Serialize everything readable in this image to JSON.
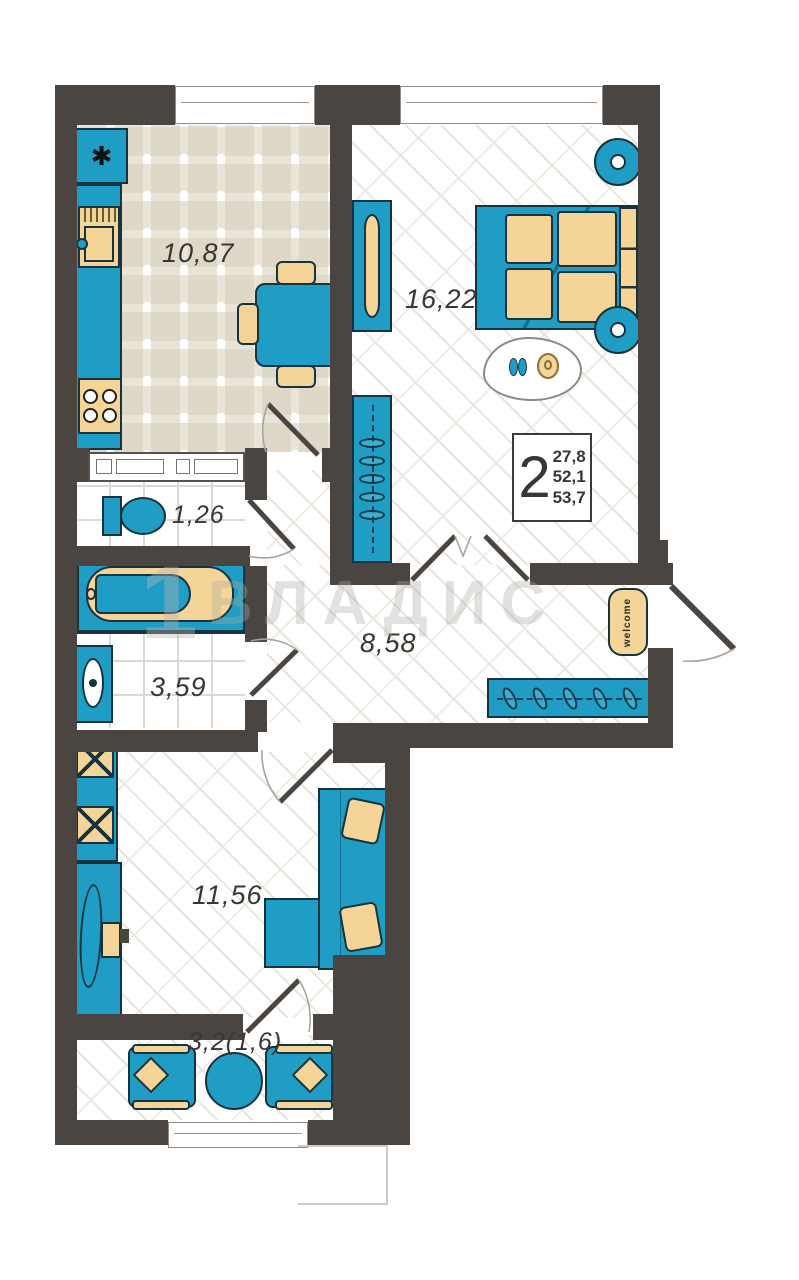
{
  "plan_title": "2-room apartment floor plan",
  "info_box": {
    "rooms_count": "2",
    "living_area": "27,8",
    "apartment_area": "52,1",
    "total_area": "53,7"
  },
  "rooms": {
    "kitchen": {
      "area": "10,87"
    },
    "bedroom": {
      "area": "16,22"
    },
    "toilet": {
      "area": "1,26"
    },
    "bathroom": {
      "area": "3,59"
    },
    "hallway": {
      "area": "8,58"
    },
    "living_room": {
      "area": "11,56"
    },
    "balcony": {
      "area": "3,2(1,6)"
    }
  },
  "entrance_mat_text": "welcome",
  "watermark": {
    "logo": "1",
    "text": "ВЛАДИС"
  },
  "icons": {
    "fridge_snowflake": "✱"
  },
  "colors": {
    "wall": "#4a4541",
    "furniture_teal": "#1f9dc4",
    "accent_tan": "#f4d497",
    "outline": "#17333e"
  }
}
